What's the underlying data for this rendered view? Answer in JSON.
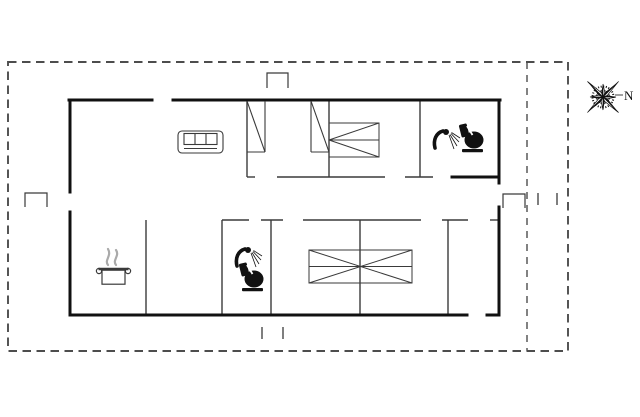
{
  "compass": {
    "label": "N",
    "cx": 603,
    "cy": 97
  },
  "colors": {
    "wall": "#111111",
    "thin": "#3a3a3a",
    "furniture": "#3a3a3a",
    "boundary": "#4d4d4d",
    "steam": "#aaaaaa",
    "background": "#ffffff"
  },
  "plan": {
    "width": 640,
    "height": 417,
    "boundary": {
      "x": 8,
      "y": 62,
      "w": 560,
      "h": 289,
      "inner_x": 527
    },
    "bold_walls": [
      [
        69,
        100,
        152,
        100
      ],
      [
        173,
        100,
        500,
        100
      ],
      [
        70,
        100,
        70,
        192
      ],
      [
        70,
        212,
        70,
        315
      ],
      [
        499,
        100,
        499,
        183
      ],
      [
        499,
        207,
        499,
        315
      ],
      [
        70,
        315,
        467,
        315
      ],
      [
        487,
        315,
        499,
        315
      ],
      [
        452,
        177,
        499,
        177
      ]
    ],
    "thin_walls": [
      [
        247,
        177,
        255,
        177
      ],
      [
        277,
        177,
        385,
        177
      ],
      [
        405,
        177,
        433,
        177
      ],
      [
        247,
        100,
        247,
        177
      ],
      [
        329,
        100,
        329,
        177
      ],
      [
        420,
        100,
        420,
        177
      ],
      [
        222,
        220,
        249,
        220
      ],
      [
        261,
        220,
        283,
        220
      ],
      [
        303,
        220,
        421,
        220
      ],
      [
        442,
        220,
        468,
        220
      ],
      [
        490,
        220,
        499,
        220
      ],
      [
        146,
        220,
        146,
        315
      ],
      [
        222,
        220,
        222,
        315
      ],
      [
        271,
        220,
        271,
        315
      ],
      [
        360,
        220,
        360,
        315
      ],
      [
        448,
        220,
        448,
        315
      ]
    ],
    "wardrobes": [
      {
        "x": 247,
        "y": 101,
        "w": 18,
        "h": 51,
        "open": "left"
      },
      {
        "x": 311,
        "y": 101,
        "w": 18,
        "h": 51,
        "open": "right"
      }
    ],
    "entrance_steps": [
      {
        "x": 267,
        "y": 73,
        "w": 21,
        "h": 15
      },
      {
        "x": 25,
        "y": 193,
        "w": 22,
        "h": 14
      },
      {
        "x": 503,
        "y": 194,
        "w": 22,
        "h": 14
      }
    ],
    "window_ticks": [
      [
        538,
        193,
        538,
        205
      ],
      [
        557,
        193,
        557,
        205
      ],
      [
        262,
        327,
        262,
        339
      ],
      [
        283,
        327,
        283,
        339
      ]
    ],
    "furniture": [
      {
        "type": "sofa",
        "x": 178,
        "y": 131,
        "w": 45,
        "h": 22
      },
      {
        "type": "bed-single",
        "x": 329,
        "y": 123,
        "w": 50,
        "h": 34
      },
      {
        "type": "bed-double",
        "x": 309,
        "y": 250,
        "w": 103,
        "h": 33
      },
      {
        "type": "pot",
        "x": 95,
        "y": 244,
        "w": 37,
        "h": 41
      },
      {
        "type": "shower",
        "x": 434,
        "y": 127
      },
      {
        "type": "toilet",
        "x": 459,
        "y": 123
      },
      {
        "type": "shower",
        "x": 236,
        "y": 245
      },
      {
        "type": "toilet",
        "x": 239,
        "y": 262
      }
    ]
  }
}
